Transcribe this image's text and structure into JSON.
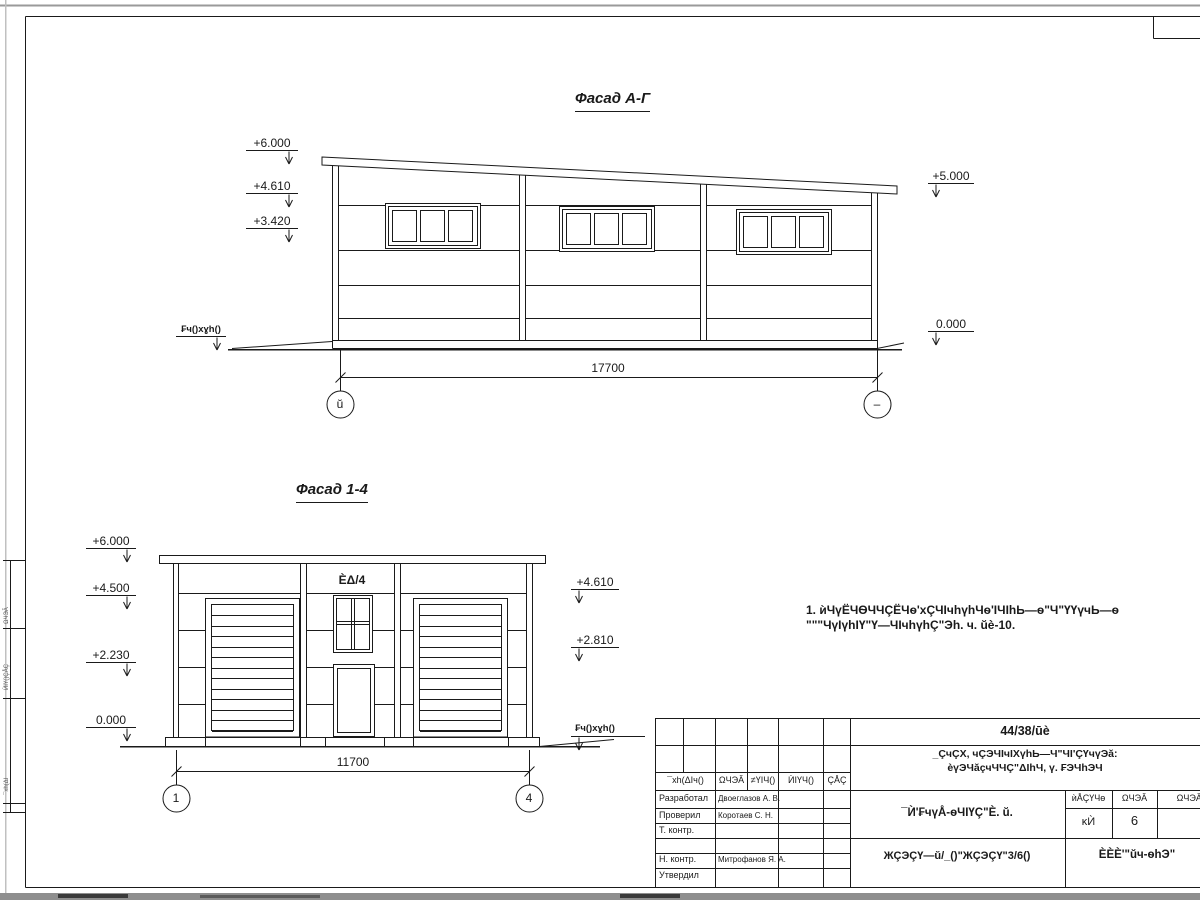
{
  "facade_ag": {
    "title": "Фасад А-Г",
    "elev_6000": "+6.000",
    "elev_4610": "+4.610",
    "elev_3420": "+3.420",
    "elev_5000": "+5.000",
    "elev_0000": "0.000",
    "ground_label": "₣ч()хɣh()",
    "dimension": "17700",
    "axis_left": "ŭ",
    "axis_right": "–"
  },
  "facade_14": {
    "title": "Фасад 1-4",
    "elev_6000": "+6.000",
    "elev_4500": "+4.500",
    "elev_2230": "+2.230",
    "elev_0000": "0.000",
    "elev_4610": "+4.610",
    "elev_2810": "+2.810",
    "ground_label": "₣ч()хɣh()",
    "window_label": "ÈΔ/4",
    "dimension": "11700",
    "axis_left": "1",
    "axis_right": "4"
  },
  "note": {
    "line1": "1. ѝЧүЁЧѲЧЧÇЁЧѳ'хÇЧІчhүhЧѳ'ІЧІhЬ—ѳ\"Ч\"ҮҮүчЬ—ѳ",
    "line2": "\"\"\"ЧүІүhІҮ\"Ү—ЧІчhүhÇ\"Эh. ч. ŭè-10."
  },
  "titleblock": {
    "code": "44/38/ūè",
    "project_line1": "_ÇчÇХ, чÇЭЧІчІХүhЬ—Ч\"ЧІ'ÇҮчүЭă:",
    "project_line2": "èүЭЧăçчЧЧÇ\"ΔІhЧ, ү. ₣ЭЧhЭЧ",
    "doc_cols": [
      "¯хh(ΔІч()",
      "ΩЧЭĂ",
      "≠ҮІЧ()",
      "ЍІҮЧ()",
      "ÇÅÇ"
    ],
    "rows": [
      {
        "role": "Разработал",
        "name": "Двоеглазов А. В."
      },
      {
        "role": "Проверил",
        "name": "Коротаев С. Н."
      },
      {
        "role": "Т. контр.",
        "name": ""
      },
      {
        "role": "",
        "name": ""
      },
      {
        "role": "Н. контр.",
        "name": "Митрофанов Я. А."
      },
      {
        "role": "Утвердил",
        "name": ""
      }
    ],
    "sheet_title": "¯Ѝ'₣чүÅ-ѳЧІҮÇ\"È. ŭ.",
    "doc_number": "ЖÇЭÇҮ—ŭ/_()\"ЖÇЭÇҮ\"3/6()",
    "stage_headers": [
      "ѝÅÇҮЧѳ",
      "ΩЧЭĂ",
      "ΩЧЭĂІҮ"
    ],
    "stage_value": "ĸЍ",
    "sheet_number": "6",
    "company": "ÈÈÈ'\"ŭч-ѳhЭ\""
  },
  "side_labels": [
    "ЍІҮ()ÇÅÇ",
    "¯хh(ΔІ",
    "ΩЧЭĂ"
  ],
  "colors": {
    "ink": "#1a1a1a",
    "page": "#ffffff",
    "scan_edge": "#8e8e8e"
  }
}
